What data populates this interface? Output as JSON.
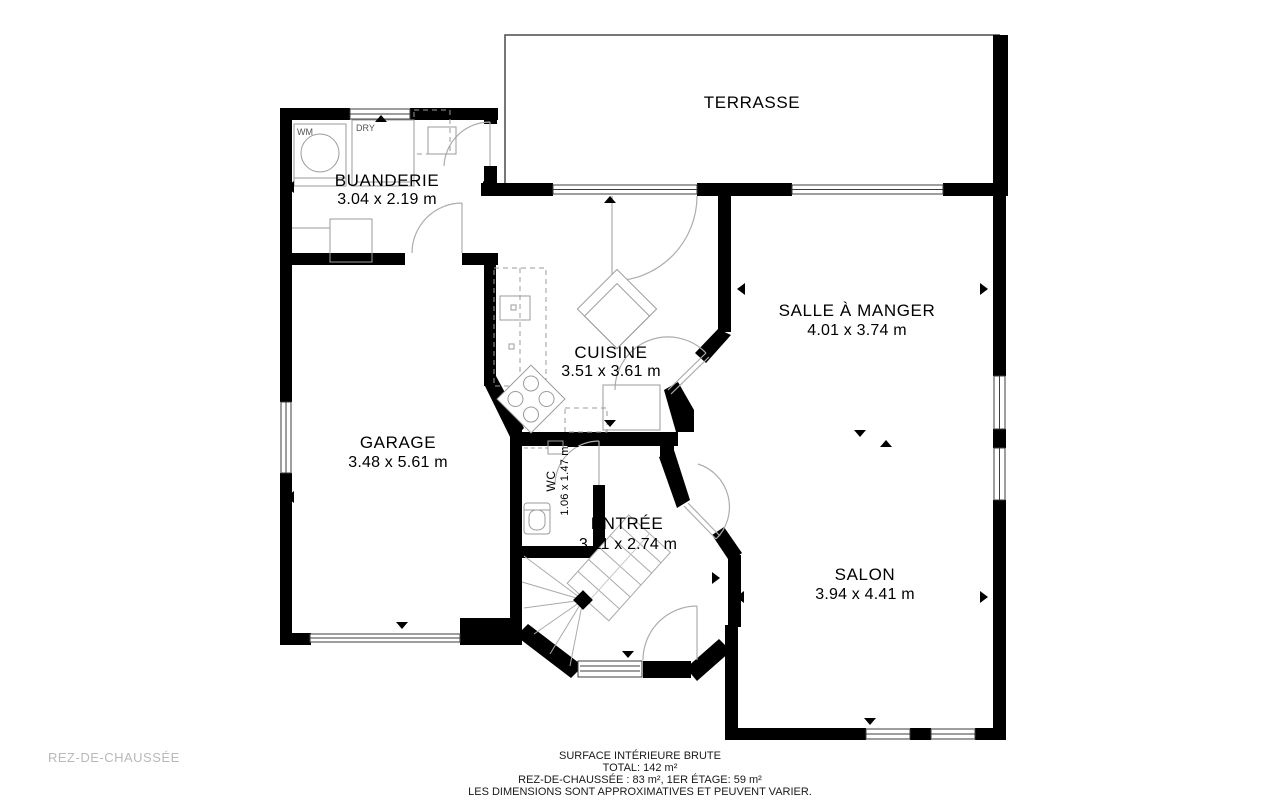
{
  "plan": {
    "floor_label": "REZ-DE-CHAUSSÉE",
    "rooms": [
      {
        "id": "terrasse",
        "name": "TERRASSE",
        "dims": ""
      },
      {
        "id": "buanderie",
        "name": "BUANDERIE",
        "dims": "3.04 x 2.19 m"
      },
      {
        "id": "cuisine",
        "name": "CUISINE",
        "dims": "3.51 x 3.61 m"
      },
      {
        "id": "salle_a_manger",
        "name": "SALLE À MANGER",
        "dims": "4.01 x 3.74 m"
      },
      {
        "id": "garage",
        "name": "GARAGE",
        "dims": "3.48 x 5.61 m"
      },
      {
        "id": "wc",
        "name": "WC",
        "dims": "1.06 x 1.47 m"
      },
      {
        "id": "entree",
        "name": "ENTRÉE",
        "dims": "3.11 x 2.74 m"
      },
      {
        "id": "salon",
        "name": "SALON",
        "dims": "3.94 x 4.41 m"
      }
    ],
    "appliances": {
      "washer": "WM",
      "dryer": "DRY"
    },
    "footer": {
      "title": "SURFACE INTÉRIEURE BRUTE",
      "total": "TOTAL: 142 m²",
      "breakdown": "REZ-DE-CHAUSSÉE : 83 m², 1ER ÉTAGE: 59 m²",
      "disclaimer": "LES DIMENSIONS SONT APPROXIMATIVES ET PEUVENT VARIER."
    },
    "colors": {
      "wall": "#000000",
      "thin_line": "#8f8f8f",
      "floor_label": "#b9b9b9",
      "background": "#ffffff"
    }
  }
}
